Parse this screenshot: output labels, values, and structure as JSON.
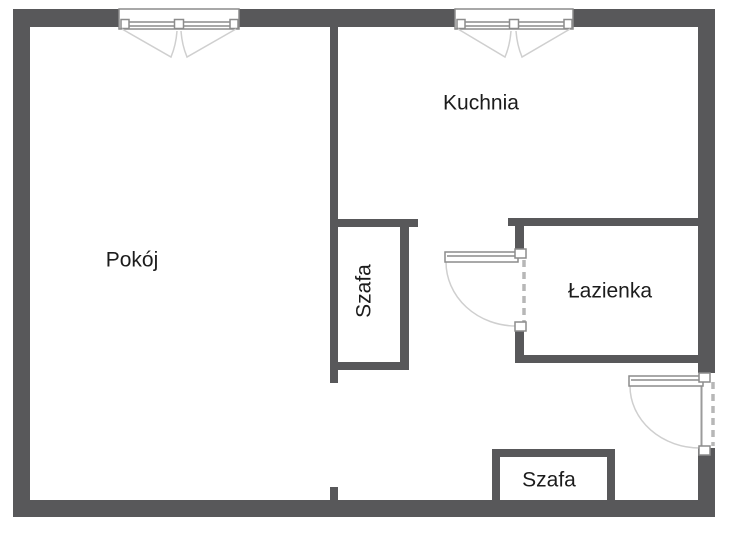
{
  "plan": {
    "type": "apartment-floor-plan",
    "rooms": [
      {
        "id": "pokoj",
        "label": "Pokój"
      },
      {
        "id": "kuchnia",
        "label": "Kuchnia"
      },
      {
        "id": "szafa-middle",
        "label": "Szafa",
        "orientation": "vertical"
      },
      {
        "id": "lazienka",
        "label": "Łazienka"
      },
      {
        "id": "szafa-bottom",
        "label": "Szafa"
      }
    ],
    "symbols": {
      "windows": [
        {
          "name": "window-top-left",
          "wall": "top"
        },
        {
          "name": "window-top-right",
          "wall": "top"
        }
      ],
      "doors": [
        {
          "name": "bathroom-door",
          "wall": "bathroom-left",
          "swing": "opens-west-into-hall"
        },
        {
          "name": "entrance-door",
          "wall": "right-exterior",
          "swing": "opens-west-into-hall"
        }
      ]
    },
    "colors": {
      "wall": "#58585a",
      "frame_line": "#8c8c8c",
      "swing_line": "#cfcfcf",
      "dashed_opening": "#b7b7b7",
      "text": "#1c1c1c",
      "background": "#ffffff"
    }
  }
}
